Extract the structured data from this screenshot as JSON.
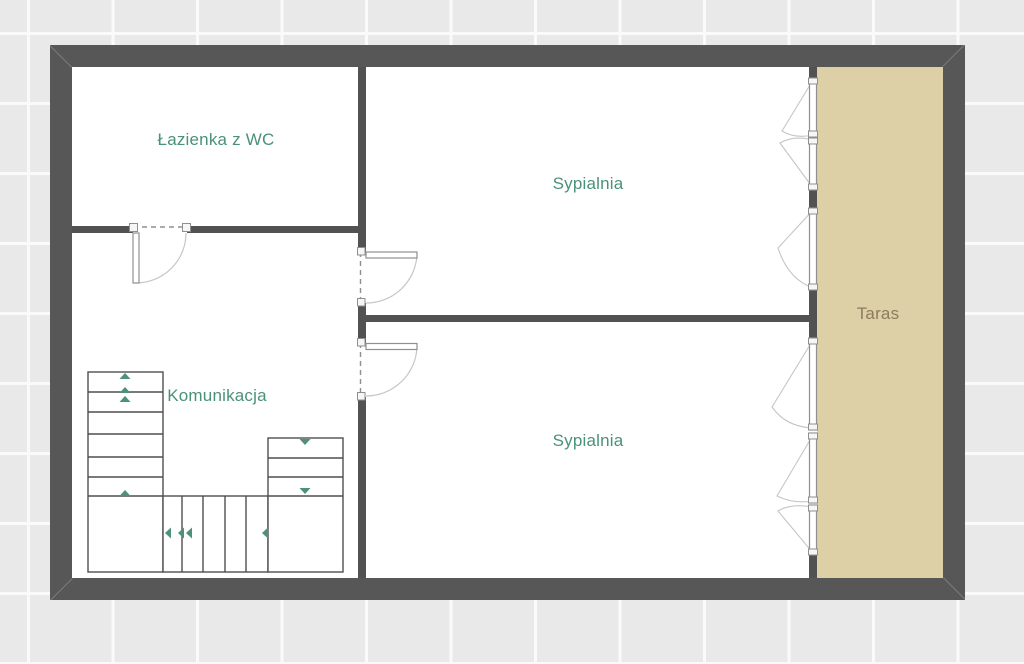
{
  "plan": {
    "rooms": {
      "bathroom": {
        "label": "Łazienka z WC"
      },
      "bedroom_top": {
        "label": "Sypialnia"
      },
      "bedroom_bottom": {
        "label": "Sypialnia"
      },
      "hallway": {
        "label": "Komunikacja"
      },
      "terrace": {
        "label": "Taras"
      }
    },
    "colors": {
      "background": "#e9e9e9",
      "grid_line": "#fafafa",
      "wall": "#575757",
      "interior_wall": "#525252",
      "room_fill": "#ffffff",
      "terrace_fill": "#ddd0a6",
      "room_label": "#4a917a",
      "terrace_label": "#8c7c5e",
      "stair_line": "#4f4f4f",
      "stair_arrow": "#4d9179",
      "frame_stroke": "#8f8f8f",
      "swing_line": "#c6c6c6"
    }
  }
}
